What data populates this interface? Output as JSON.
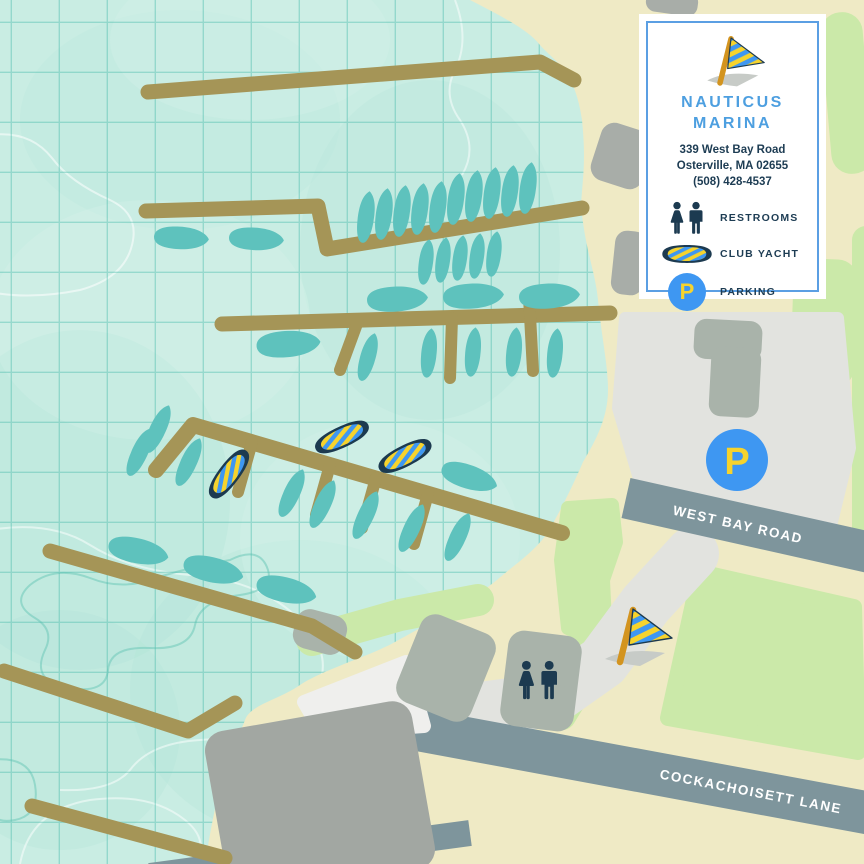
{
  "card": {
    "name_line1": "NAUTICUS",
    "name_line2": "MARINA",
    "address_line1": "339 West Bay Road",
    "address_line2": "Osterville, MA 02655",
    "phone": "(508) 428-4537",
    "legend": [
      {
        "icon": "restrooms-icon",
        "label": "RESTROOMS"
      },
      {
        "icon": "club-yacht-icon",
        "label": "CLUB YACHT"
      },
      {
        "icon": "parking-icon",
        "label": "PARKING"
      }
    ],
    "parking_symbol": "P"
  },
  "map": {
    "road_labels": {
      "west_bay_road": "WEST BAY ROAD",
      "cockachoisett_lane": "COCKACHOISETT LANE"
    },
    "parking_symbol": "P"
  },
  "colors": {
    "water": "#C9EDE3",
    "grid_line": "#53C0B0",
    "sand": "#EFEAC5",
    "grass": "#CBE9A9",
    "dock": "#A59557",
    "boat_teal": "#5EC2BD",
    "road_slate": "#7E959C",
    "parking_lot": "#E2E3DF",
    "building_gray": "#A2A7A2",
    "building_green_gray": "#A9B3AA",
    "navy": "#1C3A50",
    "brand_blue": "#4D9FE0",
    "marker_blue": "#3E97F2",
    "accent_yellow": "#F6D32D",
    "pole_orange": "#D3941F"
  }
}
